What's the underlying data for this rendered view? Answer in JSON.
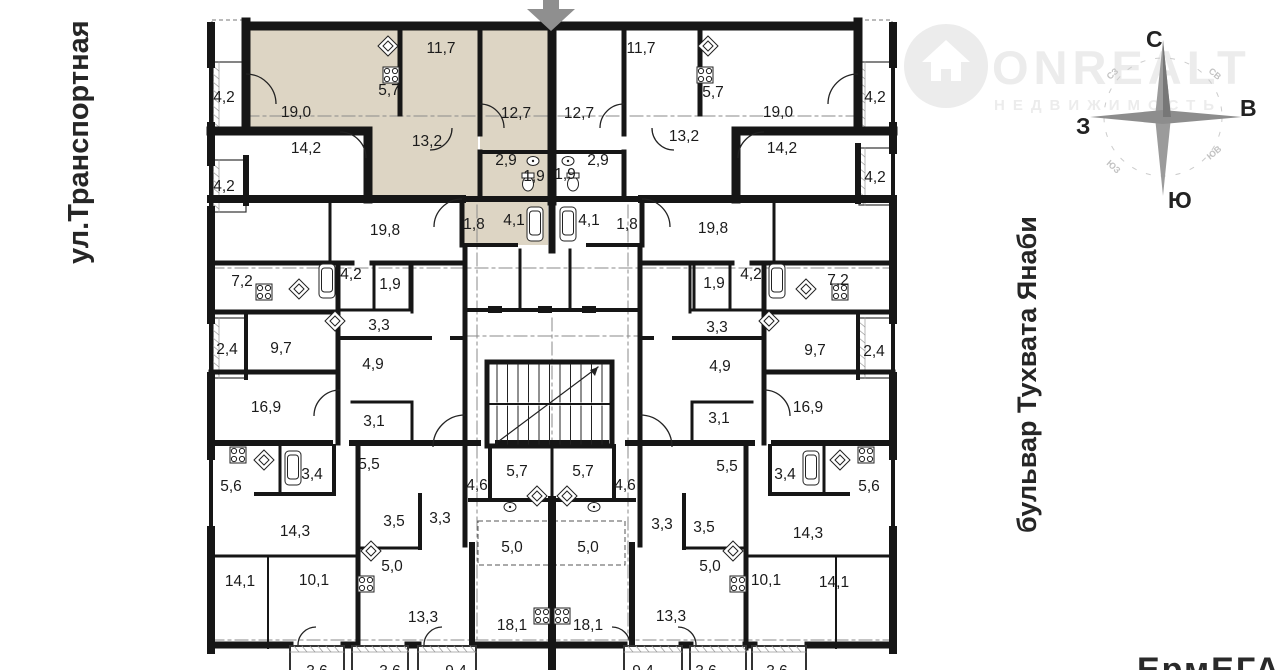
{
  "streets": {
    "left_label": "ул.Транспортная",
    "right_label": "бульвар Тухвата Янаби",
    "bottom_right_partial": "ЕрмЕГА"
  },
  "watermark": {
    "brand": "ONREALT",
    "tagline": "НЕДВИЖИМОСТЬ"
  },
  "compass": {
    "north": "С",
    "east": "В",
    "south": "Ю",
    "west": "З",
    "northwest": "СЗ",
    "northeast": "СВ",
    "southwest": "ЮЗ",
    "southeast": "ЮВ"
  },
  "colors": {
    "highlight_fill": "#ddd5c4",
    "wall": "#161616",
    "dash": "#8a8a8a",
    "watermark": "#ececec",
    "arrow": "#8f8f8f",
    "label": "#1b1b1b"
  },
  "highlighted_apartment": {
    "room_areas": [
      "19,0",
      "11,7",
      "12,7",
      "5,7",
      "13,2",
      "2,9",
      "1,9",
      "4,1",
      "1,8"
    ]
  },
  "rooms": [
    {
      "a": "4,2",
      "x": 224,
      "y": 102
    },
    {
      "a": "19,0",
      "x": 296,
      "y": 117
    },
    {
      "a": "5,7",
      "x": 389,
      "y": 95
    },
    {
      "a": "11,7",
      "x": 441,
      "y": 53
    },
    {
      "a": "12,7",
      "x": 516,
      "y": 118
    },
    {
      "a": "12,7",
      "x": 579,
      "y": 118
    },
    {
      "a": "11,7",
      "x": 641,
      "y": 53
    },
    {
      "a": "5,7",
      "x": 713,
      "y": 97
    },
    {
      "a": "13,2",
      "x": 427,
      "y": 146
    },
    {
      "a": "13,2",
      "x": 684,
      "y": 141
    },
    {
      "a": "19,0",
      "x": 778,
      "y": 117
    },
    {
      "a": "4,2",
      "x": 875,
      "y": 102
    },
    {
      "a": "14,2",
      "x": 306,
      "y": 153
    },
    {
      "a": "14,2",
      "x": 782,
      "y": 153
    },
    {
      "a": "2,9",
      "x": 506,
      "y": 165
    },
    {
      "a": "1,9",
      "x": 534,
      "y": 181
    },
    {
      "a": "1,9",
      "x": 565,
      "y": 179
    },
    {
      "a": "2,9",
      "x": 598,
      "y": 165
    },
    {
      "a": "4,2",
      "x": 224,
      "y": 191
    },
    {
      "a": "4,2",
      "x": 875,
      "y": 182
    },
    {
      "a": "1,8",
      "x": 474,
      "y": 229
    },
    {
      "a": "4,1",
      "x": 514,
      "y": 225
    },
    {
      "a": "4,1",
      "x": 589,
      "y": 225
    },
    {
      "a": "1,8",
      "x": 627,
      "y": 229
    },
    {
      "a": "19,8",
      "x": 385,
      "y": 235
    },
    {
      "a": "19,8",
      "x": 713,
      "y": 233
    },
    {
      "a": "7,2",
      "x": 242,
      "y": 286
    },
    {
      "a": "4,2",
      "x": 351,
      "y": 279
    },
    {
      "a": "1,9",
      "x": 390,
      "y": 289
    },
    {
      "a": "1,9",
      "x": 714,
      "y": 288
    },
    {
      "a": "4,2",
      "x": 751,
      "y": 279
    },
    {
      "a": "7,2",
      "x": 838,
      "y": 285
    },
    {
      "a": "3,3",
      "x": 379,
      "y": 330
    },
    {
      "a": "3,3",
      "x": 717,
      "y": 332
    },
    {
      "a": "2,4",
      "x": 227,
      "y": 354
    },
    {
      "a": "9,7",
      "x": 281,
      "y": 353
    },
    {
      "a": "9,7",
      "x": 815,
      "y": 355
    },
    {
      "a": "2,4",
      "x": 874,
      "y": 356
    },
    {
      "a": "4,9",
      "x": 373,
      "y": 369
    },
    {
      "a": "4,9",
      "x": 720,
      "y": 371
    },
    {
      "a": "16,9",
      "x": 266,
      "y": 412
    },
    {
      "a": "16,9",
      "x": 808,
      "y": 412
    },
    {
      "a": "3,1",
      "x": 374,
      "y": 426
    },
    {
      "a": "3,1",
      "x": 719,
      "y": 423
    },
    {
      "a": "5,5",
      "x": 369,
      "y": 469
    },
    {
      "a": "5,5",
      "x": 727,
      "y": 471
    },
    {
      "a": "5,7",
      "x": 517,
      "y": 476
    },
    {
      "a": "5,7",
      "x": 583,
      "y": 476
    },
    {
      "a": "4,6",
      "x": 477,
      "y": 490
    },
    {
      "a": "4,6",
      "x": 625,
      "y": 490
    },
    {
      "a": "5,6",
      "x": 231,
      "y": 491
    },
    {
      "a": "5,6",
      "x": 869,
      "y": 491
    },
    {
      "a": "3,4",
      "x": 312,
      "y": 479
    },
    {
      "a": "3,4",
      "x": 785,
      "y": 479
    },
    {
      "a": "3,3",
      "x": 440,
      "y": 523
    },
    {
      "a": "3,3",
      "x": 662,
      "y": 529
    },
    {
      "a": "3,5",
      "x": 394,
      "y": 526
    },
    {
      "a": "3,5",
      "x": 704,
      "y": 532
    },
    {
      "a": "14,3",
      "x": 295,
      "y": 536
    },
    {
      "a": "14,3",
      "x": 808,
      "y": 538
    },
    {
      "a": "5,0",
      "x": 392,
      "y": 571
    },
    {
      "a": "5,0",
      "x": 512,
      "y": 552
    },
    {
      "a": "5,0",
      "x": 588,
      "y": 552
    },
    {
      "a": "5,0",
      "x": 710,
      "y": 571
    },
    {
      "a": "14,1",
      "x": 240,
      "y": 586
    },
    {
      "a": "14,1",
      "x": 834,
      "y": 587
    },
    {
      "a": "10,1",
      "x": 314,
      "y": 585
    },
    {
      "a": "10,1",
      "x": 766,
      "y": 585
    },
    {
      "a": "13,3",
      "x": 423,
      "y": 622
    },
    {
      "a": "13,3",
      "x": 671,
      "y": 621
    },
    {
      "a": "18,1",
      "x": 512,
      "y": 630
    },
    {
      "a": "18,1",
      "x": 588,
      "y": 630
    },
    {
      "a": "3,6",
      "x": 317,
      "y": 676
    },
    {
      "a": "3,6",
      "x": 390,
      "y": 676
    },
    {
      "a": "9,4",
      "x": 456,
      "y": 676
    },
    {
      "a": "9,4",
      "x": 643,
      "y": 676
    },
    {
      "a": "3,6",
      "x": 706,
      "y": 676
    },
    {
      "a": "3,6",
      "x": 777,
      "y": 676
    }
  ],
  "fixtures": [
    {
      "icon": "shower-icon",
      "x": 388,
      "y": 46
    },
    {
      "icon": "stove-icon",
      "x": 391,
      "y": 75
    },
    {
      "icon": "shower-icon",
      "x": 708,
      "y": 46
    },
    {
      "icon": "stove-icon",
      "x": 705,
      "y": 75
    },
    {
      "icon": "sink-icon",
      "x": 533,
      "y": 161
    },
    {
      "icon": "sink-icon",
      "x": 568,
      "y": 161
    },
    {
      "icon": "toilet-icon",
      "x": 528,
      "y": 184
    },
    {
      "icon": "toilet-icon",
      "x": 573,
      "y": 184
    },
    {
      "icon": "tub-icon",
      "x": 535,
      "y": 224
    },
    {
      "icon": "tub-icon",
      "x": 568,
      "y": 224
    },
    {
      "icon": "stove-icon",
      "x": 264,
      "y": 292
    },
    {
      "icon": "shower-icon",
      "x": 299,
      "y": 289
    },
    {
      "icon": "shower-icon",
      "x": 806,
      "y": 289
    },
    {
      "icon": "stove-icon",
      "x": 840,
      "y": 292
    },
    {
      "icon": "tub-icon",
      "x": 327,
      "y": 281
    },
    {
      "icon": "tub-icon",
      "x": 777,
      "y": 281
    },
    {
      "icon": "shower-icon",
      "x": 335,
      "y": 321
    },
    {
      "icon": "shower-icon",
      "x": 769,
      "y": 321
    },
    {
      "icon": "stove-icon",
      "x": 238,
      "y": 455
    },
    {
      "icon": "shower-icon",
      "x": 264,
      "y": 460
    },
    {
      "icon": "shower-icon",
      "x": 840,
      "y": 460
    },
    {
      "icon": "stove-icon",
      "x": 866,
      "y": 455
    },
    {
      "icon": "tub-icon",
      "x": 293,
      "y": 468
    },
    {
      "icon": "tub-icon",
      "x": 811,
      "y": 468
    },
    {
      "icon": "shower-icon",
      "x": 537,
      "y": 496
    },
    {
      "icon": "shower-icon",
      "x": 567,
      "y": 496
    },
    {
      "icon": "sink-icon",
      "x": 510,
      "y": 507
    },
    {
      "icon": "sink-icon",
      "x": 594,
      "y": 507
    },
    {
      "icon": "shower-icon",
      "x": 371,
      "y": 551
    },
    {
      "icon": "shower-icon",
      "x": 733,
      "y": 551
    },
    {
      "icon": "stove-icon",
      "x": 366,
      "y": 584
    },
    {
      "icon": "stove-icon",
      "x": 738,
      "y": 584
    },
    {
      "icon": "stove-icon",
      "x": 542,
      "y": 616
    },
    {
      "icon": "stove-icon",
      "x": 562,
      "y": 616
    }
  ]
}
